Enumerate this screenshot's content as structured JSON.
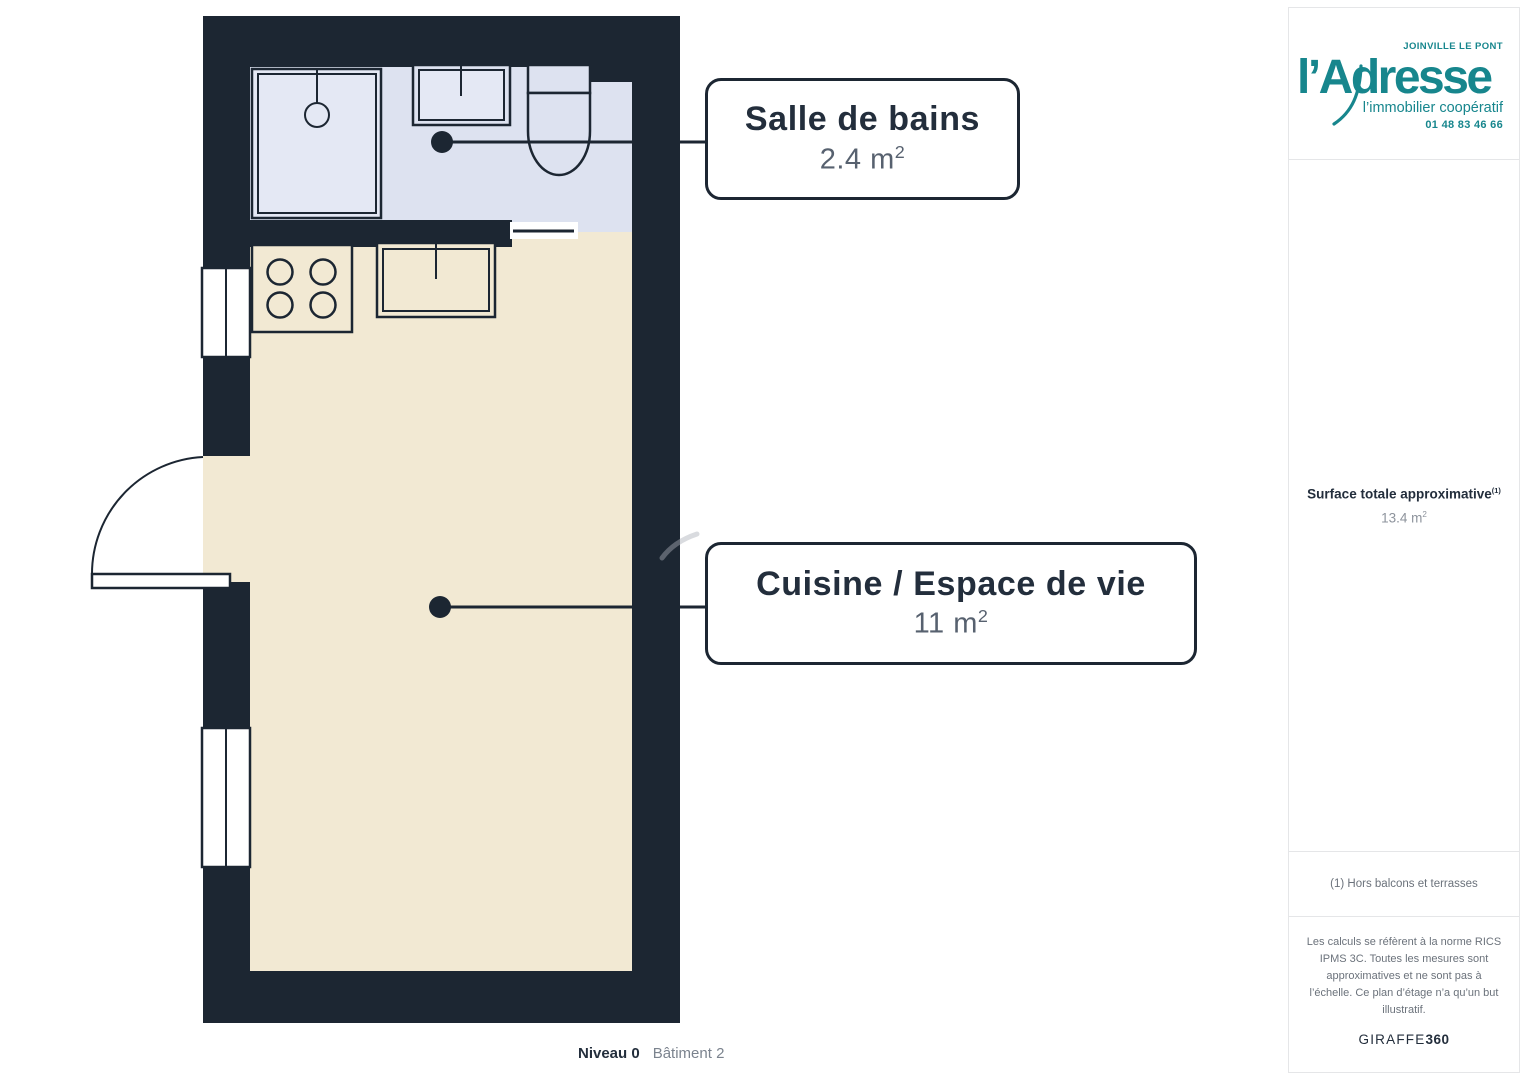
{
  "colors": {
    "wall": "#1c2632",
    "bath_floor": "#dde2f0",
    "fixture_light": "#e4e8f4",
    "kitchen_floor": "#f2e9d3",
    "navy_text": "#232e3c",
    "area_text": "#57616f",
    "teal": "#17868d",
    "panel_border": "#e5e6e8",
    "muted_text": "#6b727b",
    "value_text": "#8d939c",
    "footer_gray": "#7b838e",
    "watermark": "#aab0b8"
  },
  "plan": {
    "callouts": [
      {
        "title": "Salle de bains",
        "area_value": "2.4 m",
        "area_exp": "2"
      },
      {
        "title": "Cuisine / Espace de vie",
        "area_value": "11 m",
        "area_exp": "2"
      }
    ],
    "footer": {
      "level": "Niveau 0",
      "building": "Bâtiment 2"
    }
  },
  "sidebar": {
    "logo": {
      "city": "JOINVILLE LE PONT",
      "brand": "l’Adresse",
      "tagline": "l’immobilier coopératif",
      "phone": "01 48 83 46 66"
    },
    "surface": {
      "label": "Surface totale approximative",
      "sup": "(1)",
      "value": "13.4 m",
      "exp": "2"
    },
    "note": "(1) Hors balcons et terrasses",
    "disclaimer": "Les calculs se réfèrent à la norme RICS IPMS 3C. Toutes les mesures sont approximatives et ne sont pas à l’échelle. Ce plan d’étage n’a qu’un but illustratif.",
    "brand": {
      "name": "GIRAFFE",
      "suffix": "360"
    }
  }
}
